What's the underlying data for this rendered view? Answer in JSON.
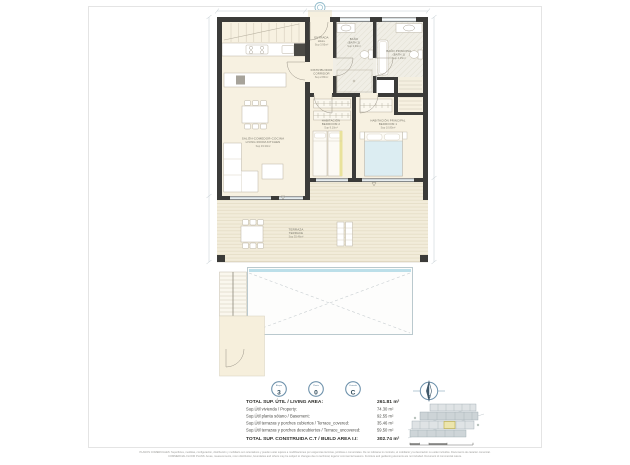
{
  "plan": {
    "rooms": {
      "living": {
        "l1": "SALÓN-COMEDOR-COCINA",
        "l2": "LIVING ROOM-KITCHEN",
        "l3": "Sup 33.30m²"
      },
      "hall": {
        "l1": "ENTRADA",
        "l2": "HALL",
        "l3": "Sup 3.95m²"
      },
      "corridor": {
        "l1": "DISTRIBUIDOR",
        "l2": "CORRIDOR",
        "l3": "Sup 2.80m²"
      },
      "bath2": {
        "l1": "BAÑO",
        "l2": "(BATH 2)",
        "l3": "Sup 3.60m²"
      },
      "bath1": {
        "l1": "BAÑO PRINCIPAL",
        "l2": "(BATH 1)",
        "l3": "Sup 4.25m²"
      },
      "bedroom2": {
        "l1": "HABITACIÓN",
        "l2": "BEDROOM 2",
        "l3": "Sup 9.10m²"
      },
      "bedroom1": {
        "l1": "HABITACIÓN PRINCIPAL",
        "l2": "BEDROOM 1",
        "l3": "Sup 10.85m²"
      },
      "terrace": {
        "l1": "TERRAZA",
        "l2": "TERRACE",
        "l3": "Sup 35.46m²"
      }
    }
  },
  "legend": {
    "badges": [
      {
        "caption": "Bloque",
        "value": "3"
      },
      {
        "caption": "Planta",
        "value": "0"
      },
      {
        "caption": "Vivienda",
        "value": "C"
      }
    ],
    "compass_letter": "S",
    "rows": [
      {
        "label": "TOTAL SUP. ÚTIL / LIVING AREA:",
        "value": "261.81 m²"
      },
      {
        "label": "Sup.Útil vivienda / Property:",
        "value": "74.30 m²"
      },
      {
        "label": "Sup.Útil planta sótano / Basement:",
        "value": "92.55 m²"
      },
      {
        "label": "Sup.Útil terrazas y porches cubiertos / Terrace_covered:",
        "value": "35.46 m²"
      },
      {
        "label": "Sup.Útil terrazas y porches descubiertos / Terrace_uncovered:",
        "value": "59.50 m²"
      },
      {
        "label": "TOTAL SUP. CONSTRUIDA C.T / BUILD AREA I.I:",
        "value": "302.74 m²"
      }
    ]
  },
  "footer": {
    "line1": "PLANOS COMERCIALES: Superficies, medidas, configuración, distribución y mobiliario son orientativos y pueden estar sujetos a modificaciones por exigencias técnicas, jurídicas o comerciales. De no indicarse lo contrario, el mobiliario y la decoración no están incluidos. Documento de carácter comercial.",
    "line2": "COMMERCIAL FLOOR PLANS: Areas, measurements, room distribution, boundaries and others may be subject to changes due to technical, legal or commercial reasons. Furniture and gardening elements are not included. Document of commercial nature."
  },
  "colors": {
    "wall": "#3b3b39",
    "floor": "#f7f1e1",
    "pool_water": "#bcdfe9",
    "accent_blue": "#6d91ab",
    "highlight_unit": "#ece5ad"
  }
}
